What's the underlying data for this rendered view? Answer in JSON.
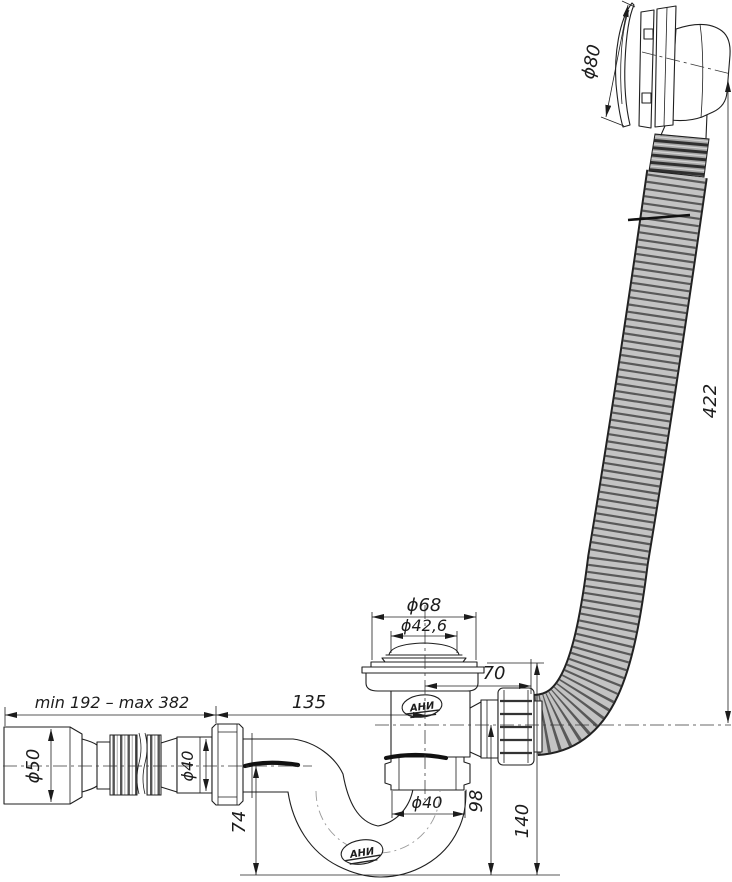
{
  "drawing": {
    "title": "bathtub-drain-overflow-siphon-technical-drawing",
    "logo": {
      "text": "АНИ"
    },
    "dimensions": {
      "overflow_diameter": "ϕ80",
      "overflow_hose_length": "422",
      "drain_flange_diameter": "ϕ68",
      "drain_cap_diameter": "ϕ42,6",
      "overflow_offset": "70",
      "flex_pipe_range": "min 192 – max 382",
      "trap_to_valve_length": "135",
      "outlet_cuff_diameter": "ϕ50",
      "flex_pipe_diameter": "ϕ40",
      "trap_nut_diameter": "ϕ40",
      "outlet_height": "74",
      "hose_axis_height": "98",
      "overall_height": "140"
    }
  }
}
